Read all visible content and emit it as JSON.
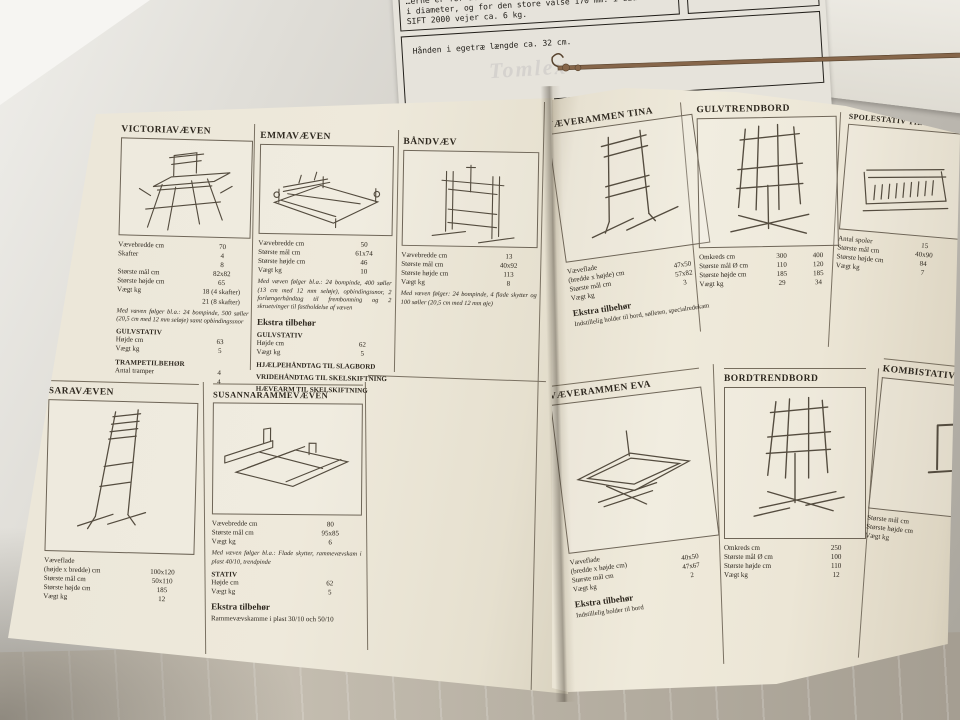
{
  "colors": {
    "paper": "#ece7d8",
    "ink": "#2e281f",
    "rule": "#7a7162",
    "table": "#bab6ae",
    "wood_tool": "#86664a"
  },
  "illustrations": {
    "victoria": "floor-loom-line-drawing",
    "emma": "table-loom-line-drawing",
    "band": "band-loom-line-drawing",
    "sara": "upright-frame-loom-line-drawing",
    "susanna": "frame-loom-with-roller-line-drawing",
    "tina": "weaving-frame-on-stand-line-drawing",
    "gulvtrend": "floor-warping-mill-line-drawing",
    "spole": "spool-rack-line-drawing",
    "eva": "flat-weaving-frame-line-drawing",
    "bordtrend": "table-warping-mill-line-drawing",
    "kombi": "combi-stand-partial-line-drawing",
    "hook": "wooden-threading-hook-photo"
  },
  "top_sheet": {
    "box1": {
      "line0": "…erne er for den lille",
      "line1": "i diameter, og for den store valse 170 mm. i diameter.",
      "line2": "SIFT 2000 vejer ca. 6 kg."
    },
    "box2": {
      "line1": "Træ med stofbund",
      "line2": "30 rækker tænder."
    },
    "box3": {
      "caption": "Hånden i egetræ længde ca. 32 cm."
    },
    "show_through": "Tomlex"
  },
  "left_page": {
    "victoria": {
      "title": "VICTORIAVÆVEN",
      "rows": [
        [
          "Vævebredde cm",
          "70"
        ],
        [
          "Skafter",
          "4"
        ],
        [
          "",
          "8"
        ],
        [
          "Største mål cm",
          "82x82"
        ],
        [
          "Største højde cm",
          "65"
        ],
        [
          "Vægt kg",
          "18 (4 skafter)"
        ],
        [
          "",
          "21 (8 skafter)"
        ]
      ],
      "note": "Med væven følger bl.a.: 24 bompinde, 500 søller (20,5 cm med 12 mm seløje) samt opbindingssnor",
      "sub1": {
        "title": "GULVSTATIV",
        "rows": [
          [
            "Højde cm",
            "63"
          ],
          [
            "Vægt kg",
            "5"
          ]
        ]
      },
      "sub2": {
        "title": "TRAMPETILBEHØR",
        "rows": [
          [
            "Antal tramper",
            "4"
          ],
          [
            "",
            "4"
          ]
        ]
      }
    },
    "emma": {
      "title": "EMMAVÆVEN",
      "rows": [
        [
          "Vævebredde cm",
          "50"
        ],
        [
          "Største mål cm",
          "61x74"
        ],
        [
          "Største højde cm",
          "46"
        ],
        [
          "Vægt kg",
          "10"
        ]
      ],
      "note": "Med væven følger bl.a.: 24 bompinde, 400 søller (13 cm med 12 mm seløje), opbindingssnor, 2 forlængerhåndtag til frembomning og 2 skruetvinger til fastholdelse af væven",
      "ekstra_label": "Ekstra tilbehør",
      "sub1": {
        "title": "GULVSTATIV",
        "rows": [
          [
            "Højde cm",
            "62"
          ],
          [
            "Vægt kg",
            "5"
          ]
        ]
      },
      "bold_lines": [
        "HJÆLPEHÅNDTAG TIL SLAGBORD",
        "VRIDEHÅNDTAG TIL SKELSKIFTNING",
        "HÆVEARM TIL SKELSKIFTNING"
      ]
    },
    "band": {
      "title": "BÅNDVÆV",
      "rows": [
        [
          "Vævebredde cm",
          "13"
        ],
        [
          "Største mål cm",
          "40x92"
        ],
        [
          "Største højde cm",
          "113"
        ],
        [
          "Vægt kg",
          "8"
        ]
      ],
      "note": "Med væven følger: 24 bompinde, 4 flade skytter og 100 søller (20,5 cm med 12 mm øje)"
    },
    "sara": {
      "title": "SARAVÆVEN",
      "rows": [
        [
          "Væveflade",
          ""
        ],
        [
          "(højde x bredde) cm",
          "100x120"
        ],
        [
          "Største mål cm",
          "50x110"
        ],
        [
          "Største højde cm",
          "185"
        ],
        [
          "Vægt kg",
          "12"
        ]
      ]
    },
    "susanna": {
      "title": "SUSANNARAMMEVÆVEN",
      "rows": [
        [
          "Vævebredde cm",
          "80"
        ],
        [
          "Største mål cm",
          "95x85"
        ],
        [
          "Vægt kg",
          "6"
        ]
      ],
      "note": "Med væven følger bl.a.: Flade skytter, rammevævskam i plast 40/10, trendpinde",
      "sub1": {
        "title": "STATIV",
        "rows": [
          [
            "Højde cm",
            "62"
          ],
          [
            "Vægt kg",
            "5"
          ]
        ]
      },
      "ekstra_label": "Ekstra tilbehør",
      "ekstra_note": "Rammevævskamme i plast 30/10 och 50/10"
    }
  },
  "right_page": {
    "tina": {
      "title": "VÆVERAMMEN TINA",
      "rows": [
        [
          "Væveflade",
          ""
        ],
        [
          "(bredde x højde) cm",
          "47x50"
        ],
        [
          "Største mål cm",
          "57x82"
        ],
        [
          "Vægt kg",
          "3"
        ]
      ],
      "ekstra_label": "Ekstra tilbehør",
      "ekstra_note": "Indstillelig holder til bord, sølleten, specialredekam"
    },
    "gulvtrend": {
      "title": "GULVTRENDBORD",
      "rows": [
        [
          "Omkreds cm",
          "300",
          "400"
        ],
        [
          "Største mål Ø cm",
          "110",
          "120"
        ],
        [
          "Største højde cm",
          "185",
          "185"
        ],
        [
          "Vægt kg",
          "29",
          "34"
        ]
      ]
    },
    "spole": {
      "title": "SPOLESTATIV TIL KRYDSNØGLER",
      "rows": [
        [
          "Antal spoler",
          "15"
        ],
        [
          "Største mål cm",
          "40x90"
        ],
        [
          "Største højde cm",
          "84"
        ],
        [
          "Vægt kg",
          "7"
        ]
      ]
    },
    "eva": {
      "title": "VÆVERAMMEN EVA",
      "rows": [
        [
          "Væveflade",
          ""
        ],
        [
          "(bredde x højde cm)",
          "40x50"
        ],
        [
          "Største mål cm",
          "47x67"
        ],
        [
          "Vægt kg",
          "2"
        ]
      ],
      "ekstra_label": "Ekstra tilbehør",
      "ekstra_note": "Indstillelig holder til bord"
    },
    "bordtrend": {
      "title": "BORDTRENDBORD",
      "rows": [
        [
          "Omkreds cm",
          "250"
        ],
        [
          "Største mål Ø cm",
          "100"
        ],
        [
          "Største højde cm",
          "110"
        ],
        [
          "Vægt kg",
          "12"
        ]
      ]
    },
    "kombi": {
      "title": "KOMBISTATIV",
      "rows": [
        [
          "Største mål cm",
          ""
        ],
        [
          "Største højde cm",
          ""
        ],
        [
          "Vægt kg",
          ""
        ]
      ]
    }
  }
}
